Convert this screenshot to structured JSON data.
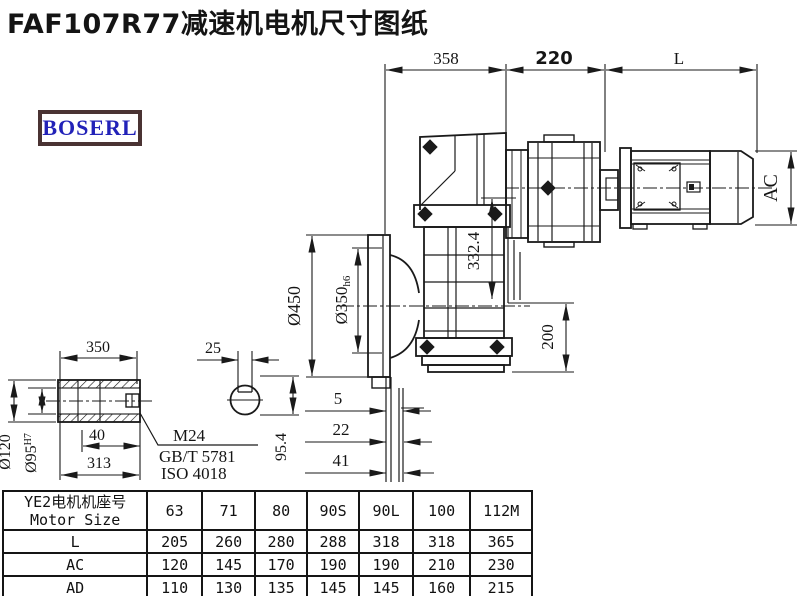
{
  "title": "FAF107R77减速机电机尺寸图纸",
  "logo": {
    "text": "BOSERL",
    "border_color": "#4a3333",
    "text_color": "#2222b8"
  },
  "drawing": {
    "line_color": "#1a1a1a",
    "dims": {
      "len_gear": "358",
      "len_adapter": "220",
      "len_motor": "L",
      "motor_dia": "AC",
      "flange_od": "Ø450",
      "spigot": "Ø350",
      "spigot_tol": "h6",
      "housing_height": "332.4",
      "center_to_base": "200",
      "off1": "5",
      "off2": "22",
      "off3": "41",
      "shaft_len": "350",
      "key_w": "25",
      "d40": "40",
      "d313": "313",
      "hub_od": "Ø120",
      "bore": "Ø95",
      "bore_tol": "H7",
      "key_h": "95.4",
      "thread": "M24",
      "std_gb": "GB/T 5781",
      "std_iso": "ISO 4018"
    }
  },
  "table": {
    "header_label_cn": "YE2电机机座号",
    "header_label_en": "Motor Size",
    "sizes": [
      "63",
      "71",
      "80",
      "90S",
      "90L",
      "100",
      "112M"
    ],
    "rows": [
      {
        "label": "L",
        "values": [
          "205",
          "260",
          "280",
          "288",
          "318",
          "318",
          "365"
        ]
      },
      {
        "label": "AC",
        "values": [
          "120",
          "145",
          "170",
          "190",
          "190",
          "210",
          "230"
        ]
      },
      {
        "label": "AD",
        "values": [
          "110",
          "130",
          "135",
          "145",
          "145",
          "160",
          "215"
        ]
      }
    ]
  }
}
